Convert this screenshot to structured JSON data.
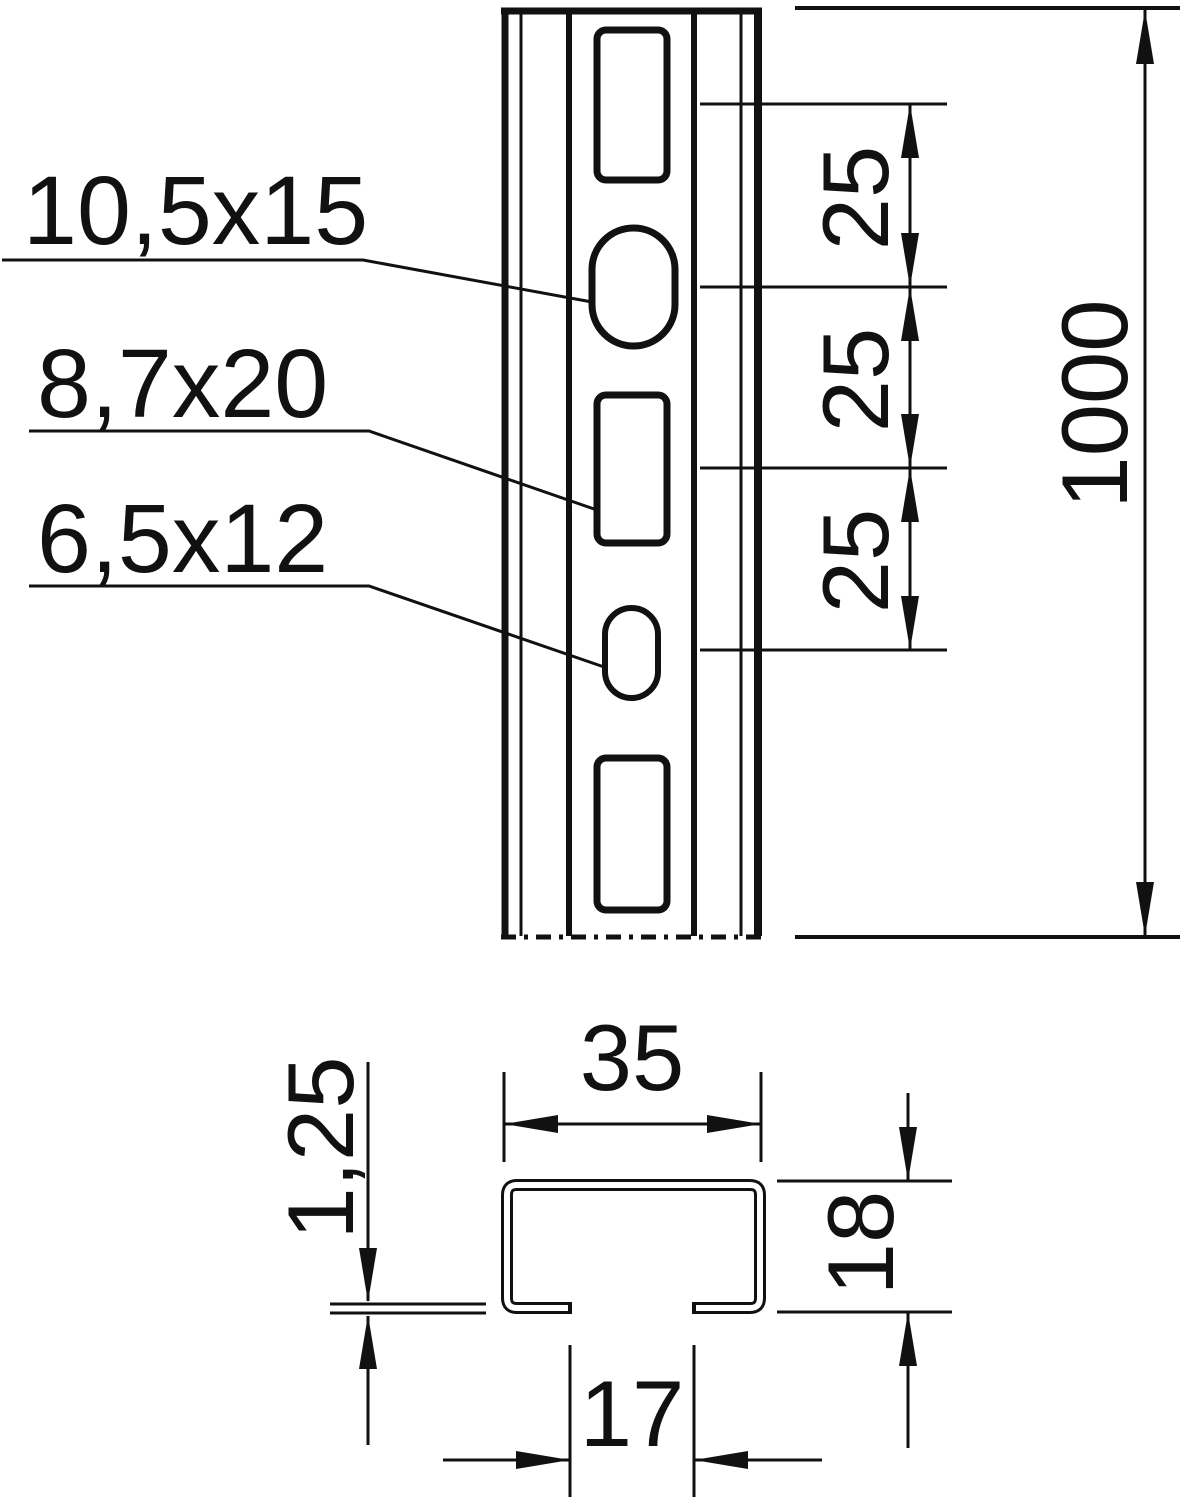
{
  "front_view": {
    "hole_labels": [
      {
        "text": "10,5x15"
      },
      {
        "text": "8,7x20"
      },
      {
        "text": "6,5x12"
      }
    ],
    "pitch_dims": [
      {
        "text": "25"
      },
      {
        "text": "25"
      },
      {
        "text": "25"
      }
    ],
    "length_dim": {
      "text": "1000"
    }
  },
  "section_view": {
    "width_dim": {
      "text": "35"
    },
    "height_dim": {
      "text": "18"
    },
    "opening_dim": {
      "text": "17"
    },
    "thickness_dim": {
      "text": "1,25"
    }
  },
  "colors": {
    "line": "#111111",
    "background": "#ffffff"
  }
}
